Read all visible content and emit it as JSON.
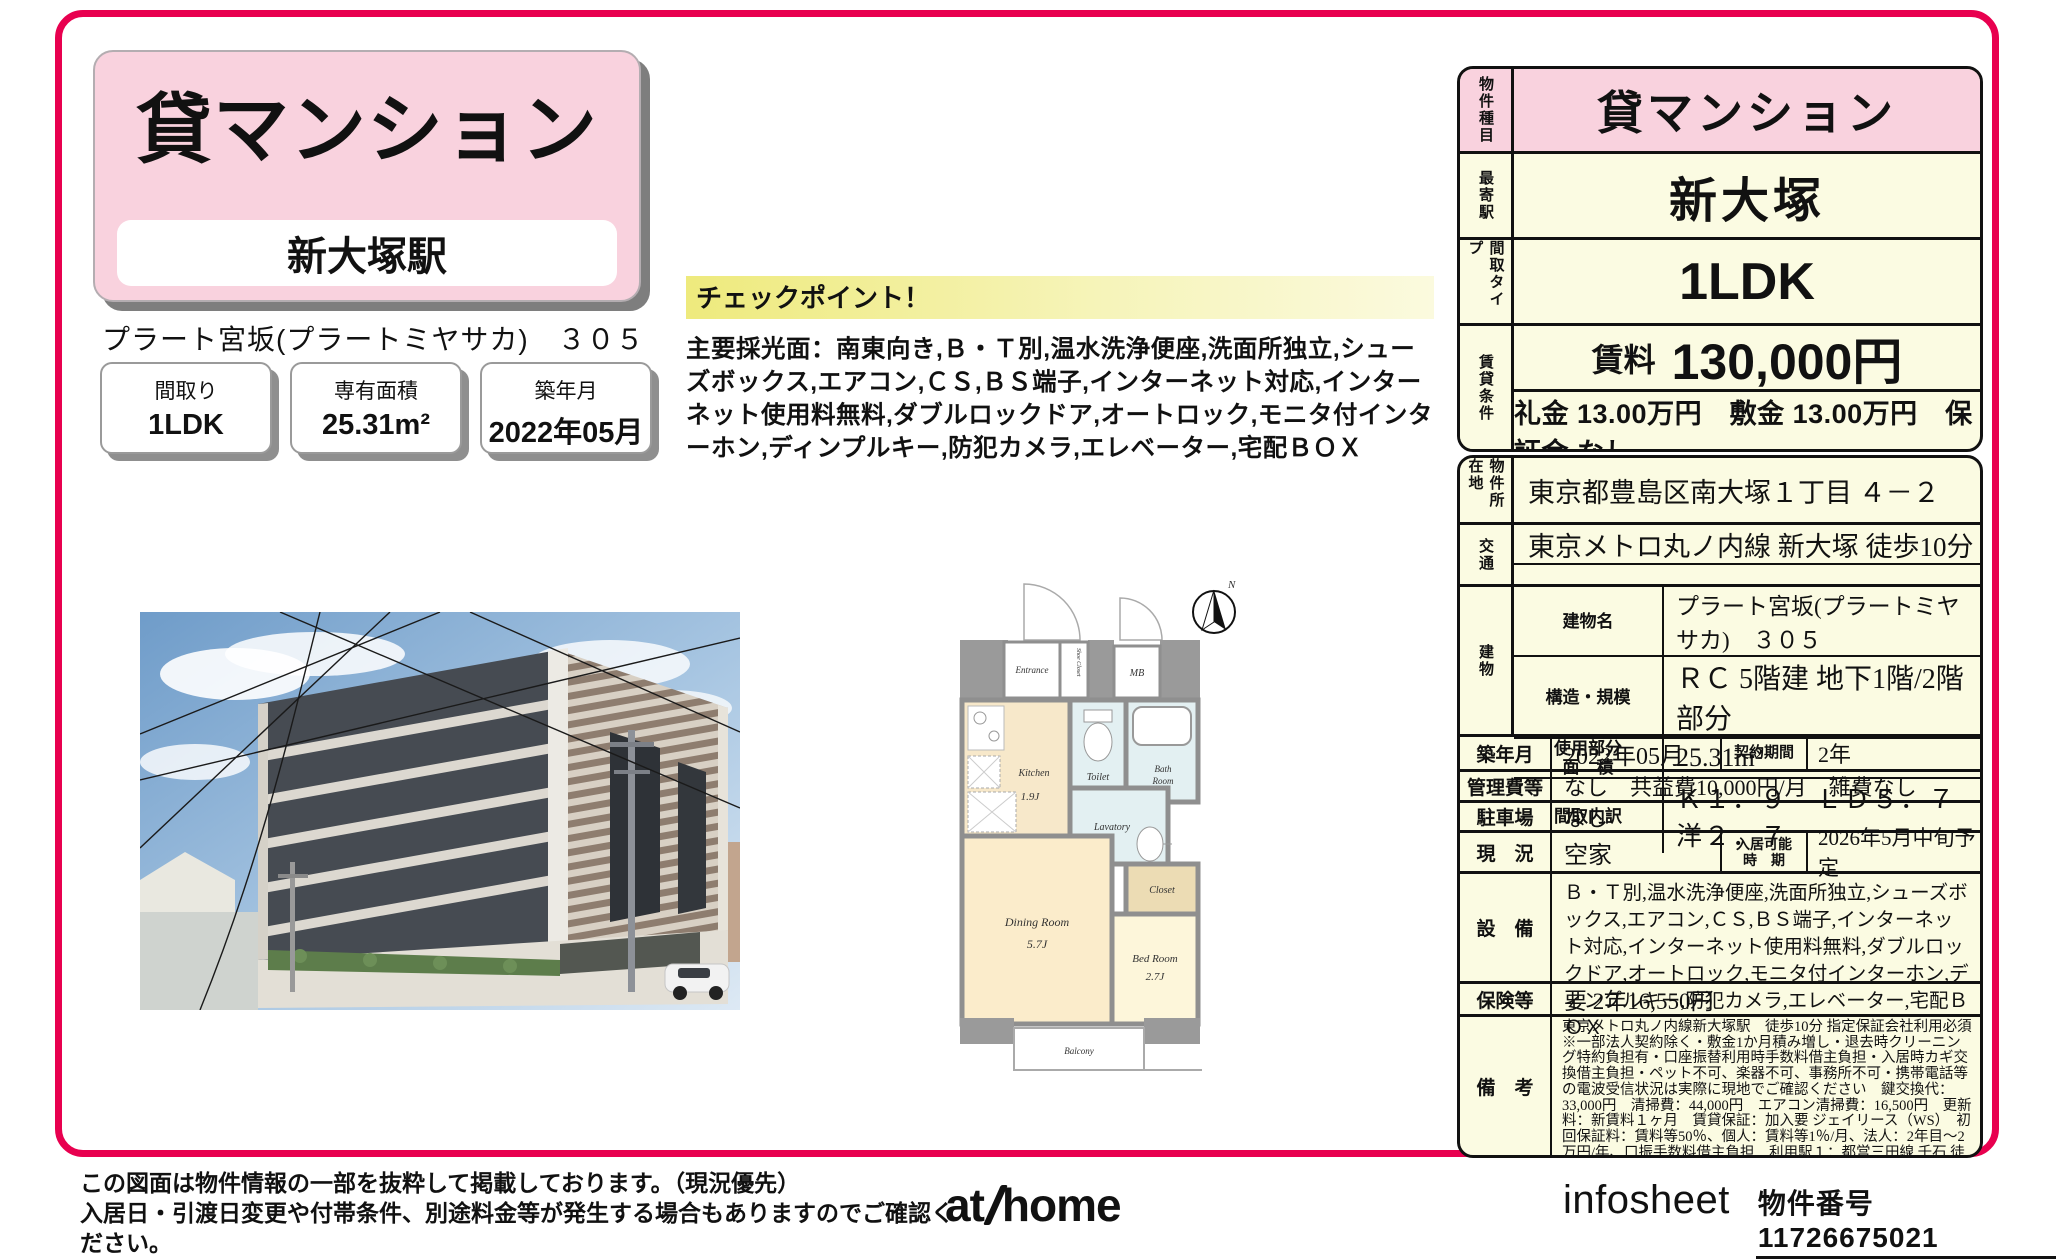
{
  "colors": {
    "accent": "#e8004f",
    "pink": "#f9d2de",
    "cream": "#fbfbe2",
    "highlight": "#eeea7d"
  },
  "header": {
    "category": "貸マンション",
    "station": "新大塚駅",
    "property_line": "プラート宮坂(プラートミヤサカ)　３０５"
  },
  "stat_boxes": [
    {
      "label": "間取り",
      "value": "1LDK"
    },
    {
      "label": "専有面積",
      "value": "25.31m²"
    },
    {
      "label": "築年月",
      "value": "2022年05月"
    }
  ],
  "checkpoint": {
    "heading": "チェックポイント！",
    "body": "主要採光面：南東向き,Ｂ・Ｔ別,温水洗浄便座,洗面所独立,シューズボックス,エアコン,ＣＳ,ＢＳ端子,インターネット対応,インターネット使用料無料,ダブルロックドア,オートロック,モニタ付インターホン,ディンプルキー,防犯カメラ,エレベーター,宅配ＢＯＸ"
  },
  "summary": {
    "type_label": "物件種目",
    "type_value": "貸マンション",
    "station_label": "最寄駅",
    "station_value": "新大塚",
    "layout_label": "間取タイプ",
    "layout_value": "1LDK",
    "terms_label": "賃貸条件",
    "rent_label": "賃料",
    "rent_value": "130,000円",
    "terms_value": "礼金 13.00万円　敷金 13.00万円　保証金 なし"
  },
  "details": {
    "address_label": "物件所在地",
    "address": "東京都豊島区南大塚１丁目 ４－２",
    "access_label": "交通",
    "access": "東京メトロ丸ノ内線 新大塚 徒歩10分",
    "building_label": "建物",
    "building_name_label": "建物名",
    "building_name": "プラート宮坂(プラートミヤサカ)　３０５",
    "structure_label": "構造・規模",
    "structure": "ＲＣ 5階建 地下1階/2階部分",
    "area_label_1": "使用部分",
    "area_label_2": "面　積",
    "area": "25.31m²",
    "layout_detail_label": "間取内訳",
    "layout_detail": "Ｋ１．９　ＬＤ５．７　洋２．７",
    "built_label": "築年月",
    "built": "2022年05月",
    "contract_label": "契約期間",
    "contract": "2年",
    "fees_label": "管理費等",
    "fees": "なし　共益費10,000円/月　雑費なし",
    "parking_label": "駐車場",
    "parking": "なし",
    "status_label": "現　況",
    "status": "空家",
    "movein_label_1": "入居可能",
    "movein_label_2": "時　期",
    "movein": "2026年5月中旬予定",
    "equipment_label": "設　備",
    "equipment": "Ｂ・Ｔ別,温水洗浄便座,洗面所独立,シューズボックス,エアコン,ＣＳ,ＢＳ端子,インターネット対応,インターネット使用料無料,ダブルロックドア,オートロック,モニタ付インターホン,ディンプルキー,防犯カメラ,エレベーター,宅配ＢＯＸ",
    "insurance_label": "保険等",
    "insurance": "要 2年16,550円",
    "remarks_label": "備　考",
    "remarks": "東京メトロ丸ノ内線新大塚駅　徒歩10分 指定保証会社利用必須※一部法人契約除く・敷金1か月積み増し・退去時クリーニング特約負担有・口座振替利用時手数料借主負担・入居時カギ交換借主負担・ペット不可、楽器不可、事務所不可・携帯電話等の電波受信状況は実際に現地でご確認ください　鍵交換代：33,000円　清掃費：44,000円　エアコン清掃費：16,500円　更新料：新賃料１ヶ月　賃貸保証：加入要 ジェイリース（WS）　初回保証料：賃料等50％、個人：賃料等1％/月、法人：2年目～2万円/年、口振手数料借主負担　利用駅１：都営三田線 千石 徒歩11分"
  },
  "floor_plan": {
    "north": "N",
    "entrance": "Entrance",
    "shoe_closet": "Shoe Closet",
    "mb": "MB",
    "kitchen": "Kitchen",
    "kitchen_size": "1.9J",
    "toilet": "Toilet",
    "bath_1": "Bath",
    "bath_2": "Room",
    "ps": "PS",
    "lavatory": "Lavatory",
    "closet": "Closet",
    "dining": "Dining Room",
    "dining_size": "5.7J",
    "bed": "Bed Room",
    "bed_size": "2.7J",
    "balcony": "Balcony"
  },
  "footer": {
    "note_1": "この図面は物件情報の一部を抜粋して掲載しております。（現況優先）",
    "note_2": "入居日・引渡日変更や付帯条件、別途料金等が発生する場合もありますのでご確認ください。",
    "logo_at": "at",
    "logo_home": "home",
    "brand": "infosheet",
    "property_no_label": "物件番号　11726675021"
  }
}
